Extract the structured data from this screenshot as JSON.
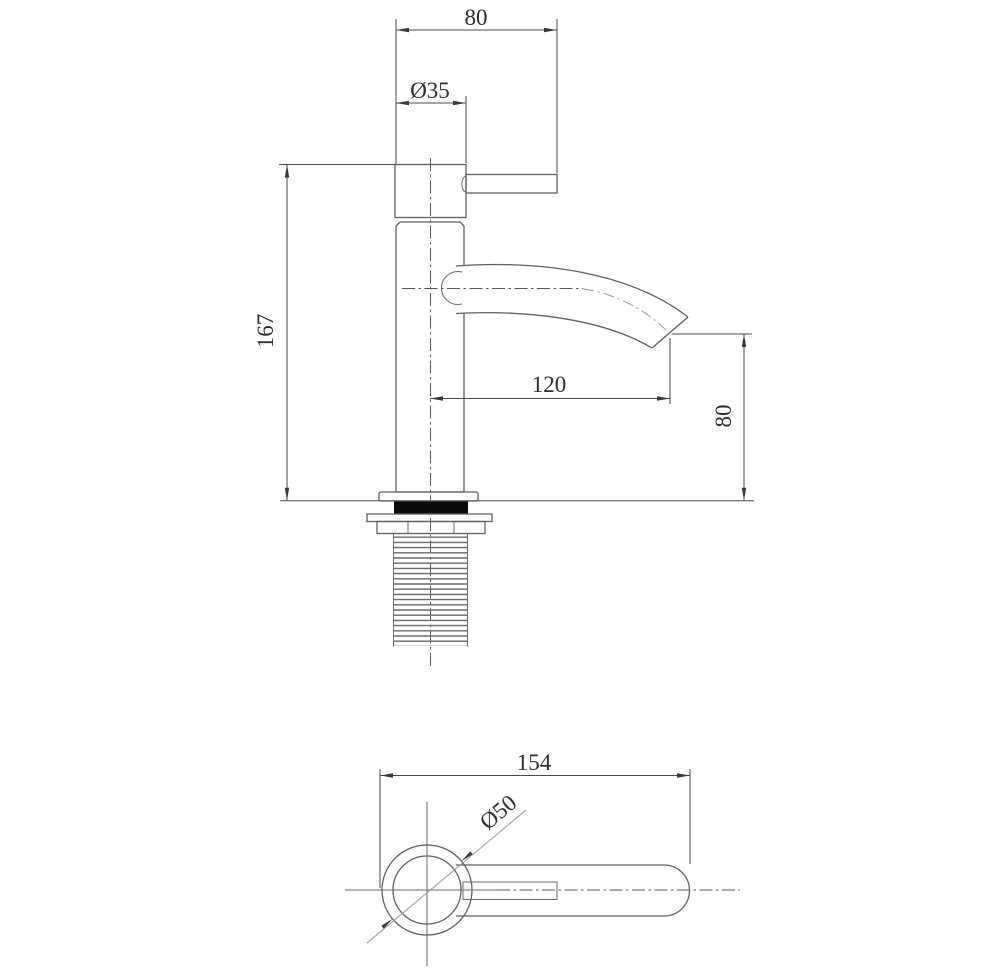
{
  "drawing": {
    "title": "faucet technical drawing",
    "views": {
      "side": "side elevation",
      "plan": "plan view"
    },
    "dims": {
      "top_width": "80",
      "head_diameter": "Ø35",
      "total_height": "167",
      "spout_reach": "120",
      "outlet_height": "80",
      "overall_length": "154",
      "base_diameter": "Ø50"
    },
    "colors": {
      "background": "#ffffff",
      "object_line": "#606060",
      "dimension_line": "#4a4a4a",
      "text": "#2e2e2e",
      "gasket_fill": "#0a0a0a",
      "centerline_light": "#9a9a9a"
    }
  }
}
